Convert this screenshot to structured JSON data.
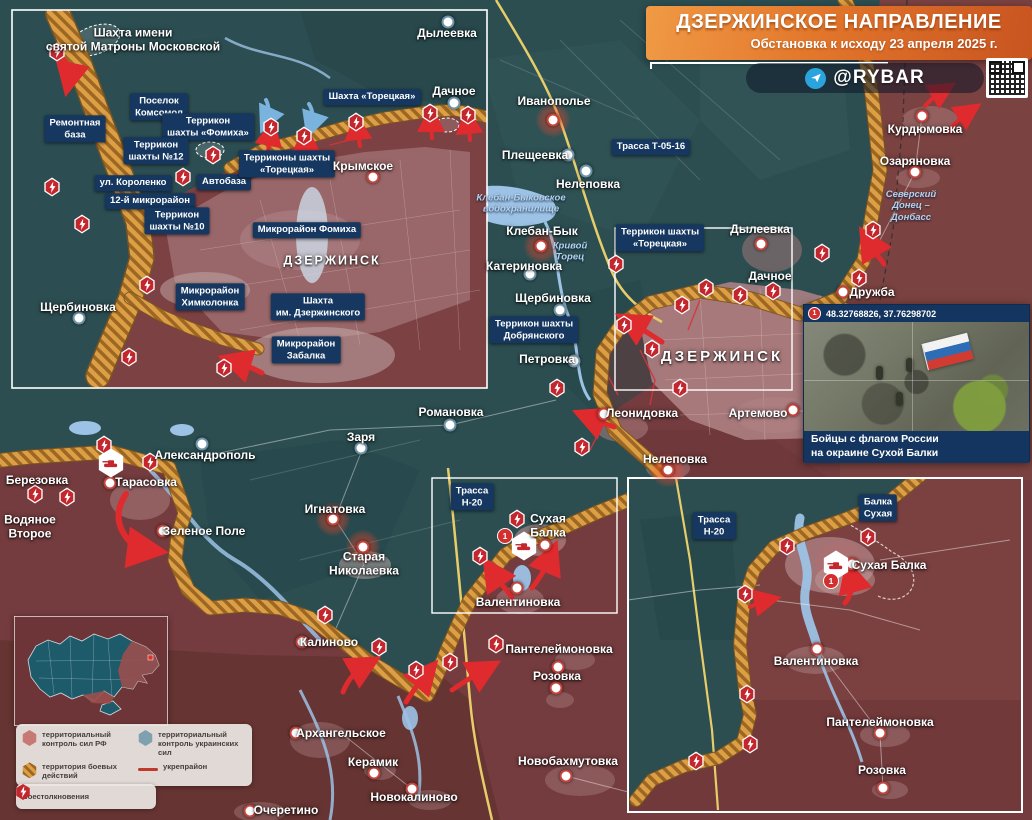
{
  "header": {
    "title": "ДЗЕРЖИНСКОЕ НАПРАВЛЕНИЕ",
    "subtitle": "Обстановка к исходу 23 апреля 2025 г.",
    "channel": "@RYBAR"
  },
  "photo_inset": {
    "marker": "1",
    "coords": "48.32768826, 37.76298702",
    "caption": "Бойцы с флагом России\nна окраине Сухой Балки"
  },
  "legend": {
    "items": [
      {
        "kind": "rf",
        "label": "территориальный контроль сил РФ"
      },
      {
        "kind": "ua",
        "label": "территориальный контроль украинских сил"
      },
      {
        "kind": "combat",
        "label": "территория боевых действий"
      },
      {
        "kind": "line",
        "label": "укрепрайон"
      },
      {
        "kind": "clash",
        "label": "боестолкновения"
      }
    ]
  },
  "colors": {
    "rf_area": "#7b4040",
    "ua_area": "#2c4e51",
    "combat_hatch": "#dd9f45",
    "clash_icon": "#c3262c",
    "label_box": "#153760",
    "water": "#9cc2e5",
    "accent": "#e2762b"
  },
  "labels": [
    {
      "t": "Иванополье",
      "x": 554,
      "y": 101
    },
    {
      "t": "Плещеевка",
      "x": 535,
      "y": 155
    },
    {
      "t": "Нелеповка",
      "x": 588,
      "y": 184
    },
    {
      "t": "Трасса Т-05-16",
      "x": 651,
      "y": 147,
      "type": "b"
    },
    {
      "t": "Клебан-Быковское\nводохранилище",
      "x": 521,
      "y": 204,
      "type": "w"
    },
    {
      "t": "Клебан-Бык",
      "x": 542,
      "y": 231
    },
    {
      "t": "Кривой\nТорец",
      "x": 570,
      "y": 252,
      "type": "w"
    },
    {
      "t": "Катериновка",
      "x": 524,
      "y": 266
    },
    {
      "t": "Щербиновка",
      "x": 553,
      "y": 298
    },
    {
      "t": "Террикон шахты\nДобрянского",
      "x": 534,
      "y": 330,
      "type": "b"
    },
    {
      "t": "Петровка",
      "x": 547,
      "y": 359
    },
    {
      "t": "Террикон шахты\n«Торецкая»",
      "x": 660,
      "y": 238,
      "type": "b"
    },
    {
      "t": "ДЗЕРЖИНСК",
      "x": 722,
      "y": 357,
      "type": "c"
    },
    {
      "t": "Дылеевка",
      "x": 760,
      "y": 229
    },
    {
      "t": "Дачное",
      "x": 770,
      "y": 276
    },
    {
      "t": "Дружба",
      "x": 872,
      "y": 292
    },
    {
      "t": "Курдюмовка",
      "x": 925,
      "y": 129
    },
    {
      "t": "Озаряновка",
      "x": 915,
      "y": 161
    },
    {
      "t": "Северский\nДонец –\nДонбасс",
      "x": 911,
      "y": 206,
      "type": "w"
    },
    {
      "t": "Леонидовка",
      "x": 642,
      "y": 413
    },
    {
      "t": "Артемово",
      "x": 758,
      "y": 413
    },
    {
      "t": "Нелеповка",
      "x": 675,
      "y": 459
    },
    {
      "t": "Романовка",
      "x": 451,
      "y": 412
    },
    {
      "t": "Заря",
      "x": 361,
      "y": 437
    },
    {
      "t": "Александрополь",
      "x": 205,
      "y": 455
    },
    {
      "t": "Тарасовка",
      "x": 146,
      "y": 482
    },
    {
      "t": "Березовка",
      "x": 37,
      "y": 480
    },
    {
      "t": "Водяное\nВторое",
      "x": 30,
      "y": 527
    },
    {
      "t": "Зеленое Поле",
      "x": 204,
      "y": 531
    },
    {
      "t": "Игнатовка",
      "x": 335,
      "y": 509
    },
    {
      "t": "Старая\nНиколаевка",
      "x": 364,
      "y": 564
    },
    {
      "t": "Калиново",
      "x": 329,
      "y": 642
    },
    {
      "t": "Трасса\nН-20",
      "x": 472,
      "y": 497,
      "type": "b"
    },
    {
      "t": "Сухая\nБалка",
      "x": 548,
      "y": 526
    },
    {
      "t": "Валентиновка",
      "x": 518,
      "y": 602
    },
    {
      "t": "Пантелеймоновка",
      "x": 559,
      "y": 649
    },
    {
      "t": "Розовка",
      "x": 557,
      "y": 676
    },
    {
      "t": "Архангельское",
      "x": 341,
      "y": 733
    },
    {
      "t": "Керамик",
      "x": 373,
      "y": 762
    },
    {
      "t": "Новокалиново",
      "x": 414,
      "y": 797
    },
    {
      "t": "Очеретино",
      "x": 286,
      "y": 810
    },
    {
      "t": "Новобахмутовка",
      "x": 568,
      "y": 761
    },
    {
      "t": "Шахта имени\nсвятой Матроны Московской",
      "x": 133,
      "y": 40
    },
    {
      "t": "Поселок\nКомсомол",
      "x": 159,
      "y": 107,
      "type": "b"
    },
    {
      "t": "Ремонтная\nбаза",
      "x": 75,
      "y": 129,
      "type": "b"
    },
    {
      "t": "Террикон\nшахты «Фомиха»",
      "x": 208,
      "y": 127,
      "type": "b"
    },
    {
      "t": "Террикон\nшахты №12",
      "x": 156,
      "y": 151,
      "type": "b"
    },
    {
      "t": "Автобаза",
      "x": 224,
      "y": 182,
      "type": "b"
    },
    {
      "t": "ул. Короленко",
      "x": 133,
      "y": 183,
      "type": "b"
    },
    {
      "t": "12-й микрорайон",
      "x": 150,
      "y": 201,
      "type": "b"
    },
    {
      "t": "Террикон\nшахты №10",
      "x": 177,
      "y": 221,
      "type": "b"
    },
    {
      "t": "Терриконы шахты\n«Торецкая»",
      "x": 287,
      "y": 164,
      "type": "b"
    },
    {
      "t": "Шахта «Торецкая»",
      "x": 372,
      "y": 97,
      "type": "b"
    },
    {
      "t": "Дачное",
      "x": 454,
      "y": 91
    },
    {
      "t": "Крымское",
      "x": 363,
      "y": 166
    },
    {
      "t": "Микрорайон Фомиха",
      "x": 307,
      "y": 230,
      "type": "b"
    },
    {
      "t": "ДЗЕРЖИНСК",
      "x": 332,
      "y": 261,
      "type": "cs"
    },
    {
      "t": "Щербиновка",
      "x": 78,
      "y": 307
    },
    {
      "t": "Микрорайон\nХимколонка",
      "x": 210,
      "y": 297,
      "type": "b"
    },
    {
      "t": "Шахта\nим. Дзержинского",
      "x": 318,
      "y": 307,
      "type": "b"
    },
    {
      "t": "Микрорайон\nЗабалка",
      "x": 306,
      "y": 350,
      "type": "b"
    },
    {
      "t": "Дылеевка",
      "x": 447,
      "y": 33
    },
    {
      "t": "Трасса\nН-20",
      "x": 714,
      "y": 526,
      "type": "b"
    },
    {
      "t": "Балка\nСухая",
      "x": 878,
      "y": 508,
      "type": "b"
    },
    {
      "t": "Сухая Балка",
      "x": 889,
      "y": 565
    },
    {
      "t": "Валентиновка",
      "x": 816,
      "y": 661
    },
    {
      "t": "Пантелеймоновка",
      "x": 880,
      "y": 722
    },
    {
      "t": "Розовка",
      "x": 882,
      "y": 770
    }
  ],
  "dots": [
    {
      "x": 553,
      "y": 120,
      "k": "gl"
    },
    {
      "x": 568,
      "y": 155,
      "k": "ua"
    },
    {
      "x": 586,
      "y": 171,
      "k": "ua"
    },
    {
      "x": 541,
      "y": 246,
      "k": "gl"
    },
    {
      "x": 530,
      "y": 274,
      "k": "ua"
    },
    {
      "x": 560,
      "y": 310,
      "k": "ua"
    },
    {
      "x": 574,
      "y": 361,
      "k": "ua"
    },
    {
      "x": 761,
      "y": 244,
      "k": "rf"
    },
    {
      "x": 843,
      "y": 292,
      "k": "rf"
    },
    {
      "x": 922,
      "y": 116,
      "k": "rf"
    },
    {
      "x": 915,
      "y": 172,
      "k": "rf"
    },
    {
      "x": 604,
      "y": 414,
      "k": "rf"
    },
    {
      "x": 793,
      "y": 410,
      "k": "rf"
    },
    {
      "x": 668,
      "y": 470,
      "k": "gl"
    },
    {
      "x": 450,
      "y": 425,
      "k": "ua"
    },
    {
      "x": 361,
      "y": 448,
      "k": "ua"
    },
    {
      "x": 202,
      "y": 444,
      "k": "ua"
    },
    {
      "x": 110,
      "y": 483,
      "k": "rf"
    },
    {
      "x": 163,
      "y": 531,
      "k": "rf"
    },
    {
      "x": 333,
      "y": 519,
      "k": "gl"
    },
    {
      "x": 363,
      "y": 547,
      "k": "gl"
    },
    {
      "x": 302,
      "y": 642,
      "k": "rf"
    },
    {
      "x": 545,
      "y": 545,
      "k": "rf"
    },
    {
      "x": 517,
      "y": 588,
      "k": "rf"
    },
    {
      "x": 558,
      "y": 667,
      "k": "rf"
    },
    {
      "x": 556,
      "y": 688,
      "k": "rf"
    },
    {
      "x": 296,
      "y": 733,
      "k": "rf"
    },
    {
      "x": 374,
      "y": 773,
      "k": "rf"
    },
    {
      "x": 412,
      "y": 789,
      "k": "rf"
    },
    {
      "x": 250,
      "y": 811,
      "k": "rf"
    },
    {
      "x": 566,
      "y": 776,
      "k": "rf"
    },
    {
      "x": 448,
      "y": 22,
      "k": "ua"
    },
    {
      "x": 454,
      "y": 103,
      "k": "ua"
    },
    {
      "x": 373,
      "y": 177,
      "k": "rf"
    },
    {
      "x": 79,
      "y": 318,
      "k": "ua"
    },
    {
      "x": 852,
      "y": 564,
      "k": "rf"
    },
    {
      "x": 817,
      "y": 649,
      "k": "rf"
    },
    {
      "x": 880,
      "y": 733,
      "k": "rf"
    },
    {
      "x": 883,
      "y": 788,
      "k": "rf"
    }
  ],
  "clash_icons": [
    {
      "x": 616,
      "y": 264
    },
    {
      "x": 682,
      "y": 305
    },
    {
      "x": 706,
      "y": 288
    },
    {
      "x": 740,
      "y": 295
    },
    {
      "x": 773,
      "y": 291
    },
    {
      "x": 624,
      "y": 325
    },
    {
      "x": 652,
      "y": 349
    },
    {
      "x": 680,
      "y": 388
    },
    {
      "x": 557,
      "y": 388
    },
    {
      "x": 582,
      "y": 447
    },
    {
      "x": 822,
      "y": 253
    },
    {
      "x": 873,
      "y": 230
    },
    {
      "x": 859,
      "y": 278
    },
    {
      "x": 104,
      "y": 445
    },
    {
      "x": 150,
      "y": 462
    },
    {
      "x": 35,
      "y": 494
    },
    {
      "x": 67,
      "y": 497
    },
    {
      "x": 325,
      "y": 615
    },
    {
      "x": 379,
      "y": 647
    },
    {
      "x": 416,
      "y": 670
    },
    {
      "x": 450,
      "y": 662
    },
    {
      "x": 480,
      "y": 556
    },
    {
      "x": 496,
      "y": 644
    },
    {
      "x": 517,
      "y": 519
    },
    {
      "x": 57,
      "y": 52
    },
    {
      "x": 52,
      "y": 187
    },
    {
      "x": 82,
      "y": 224
    },
    {
      "x": 183,
      "y": 177
    },
    {
      "x": 213,
      "y": 155
    },
    {
      "x": 271,
      "y": 127
    },
    {
      "x": 304,
      "y": 136
    },
    {
      "x": 356,
      "y": 122
    },
    {
      "x": 430,
      "y": 113
    },
    {
      "x": 468,
      "y": 115
    },
    {
      "x": 147,
      "y": 285
    },
    {
      "x": 129,
      "y": 357
    },
    {
      "x": 224,
      "y": 368
    },
    {
      "x": 868,
      "y": 537
    },
    {
      "x": 787,
      "y": 546
    },
    {
      "x": 745,
      "y": 594
    },
    {
      "x": 747,
      "y": 694
    },
    {
      "x": 750,
      "y": 744
    },
    {
      "x": 696,
      "y": 761
    }
  ],
  "hex_markers": [
    {
      "x": 111,
      "y": 463
    },
    {
      "x": 524,
      "y": 546
    },
    {
      "x": 836,
      "y": 565
    }
  ],
  "badges": [
    {
      "x": 505,
      "y": 536,
      "t": "1"
    },
    {
      "x": 831,
      "y": 581,
      "t": "1"
    }
  ],
  "arrows": [
    {
      "d": "M662,342 Q644,330 630,322",
      "c": "r",
      "w": 5
    },
    {
      "d": "M614,427 Q600,422 588,417",
      "c": "r",
      "w": 5
    },
    {
      "d": "M126,494 Q112,515 124,534 Q132,548 148,550",
      "c": "r",
      "w": 6
    },
    {
      "d": "M343,692 Q350,674 366,665",
      "c": "r",
      "w": 5
    },
    {
      "d": "M406,702 Q416,686 427,673",
      "c": "r",
      "w": 5
    },
    {
      "d": "M452,690 Q468,679 486,669",
      "c": "r",
      "w": 5
    },
    {
      "d": "M512,597 Q500,583 492,571",
      "c": "r",
      "w": 5
    },
    {
      "d": "M532,588 Q545,571 551,556",
      "c": "r",
      "w": 5
    },
    {
      "d": "M884,264 Q874,251 868,241",
      "c": "r",
      "w": 5
    },
    {
      "d": "M948,132 Q958,119 970,111",
      "c": "r",
      "w": 4
    },
    {
      "d": "M925,106 Q934,96 944,90",
      "c": "r",
      "w": 4
    },
    {
      "d": "M60,56 Q72,66 69,80",
      "c": "r",
      "w": 5
    },
    {
      "d": "M268,152 Q269,142 271,132",
      "c": "r",
      "w": 4
    },
    {
      "d": "M305,158 Q306,148 306,138",
      "c": "r",
      "w": 4
    },
    {
      "d": "M360,146 Q358,136 357,126",
      "c": "r",
      "w": 4
    },
    {
      "d": "M432,138 Q431,128 431,118",
      "c": "r",
      "w": 4
    },
    {
      "d": "M470,140 Q469,130 468,120",
      "c": "r",
      "w": 4
    },
    {
      "d": "M262,373 Q247,365 234,361",
      "c": "r",
      "w": 5
    },
    {
      "d": "M266,100 Q271,110 266,121",
      "c": "b",
      "w": 4
    },
    {
      "d": "M309,104 Q315,114 311,126",
      "c": "b",
      "w": 4
    },
    {
      "d": "M845,603 Q855,590 851,575",
      "c": "r",
      "w": 5
    },
    {
      "d": "M750,607 Q759,602 768,600",
      "c": "r",
      "w": 4
    }
  ]
}
